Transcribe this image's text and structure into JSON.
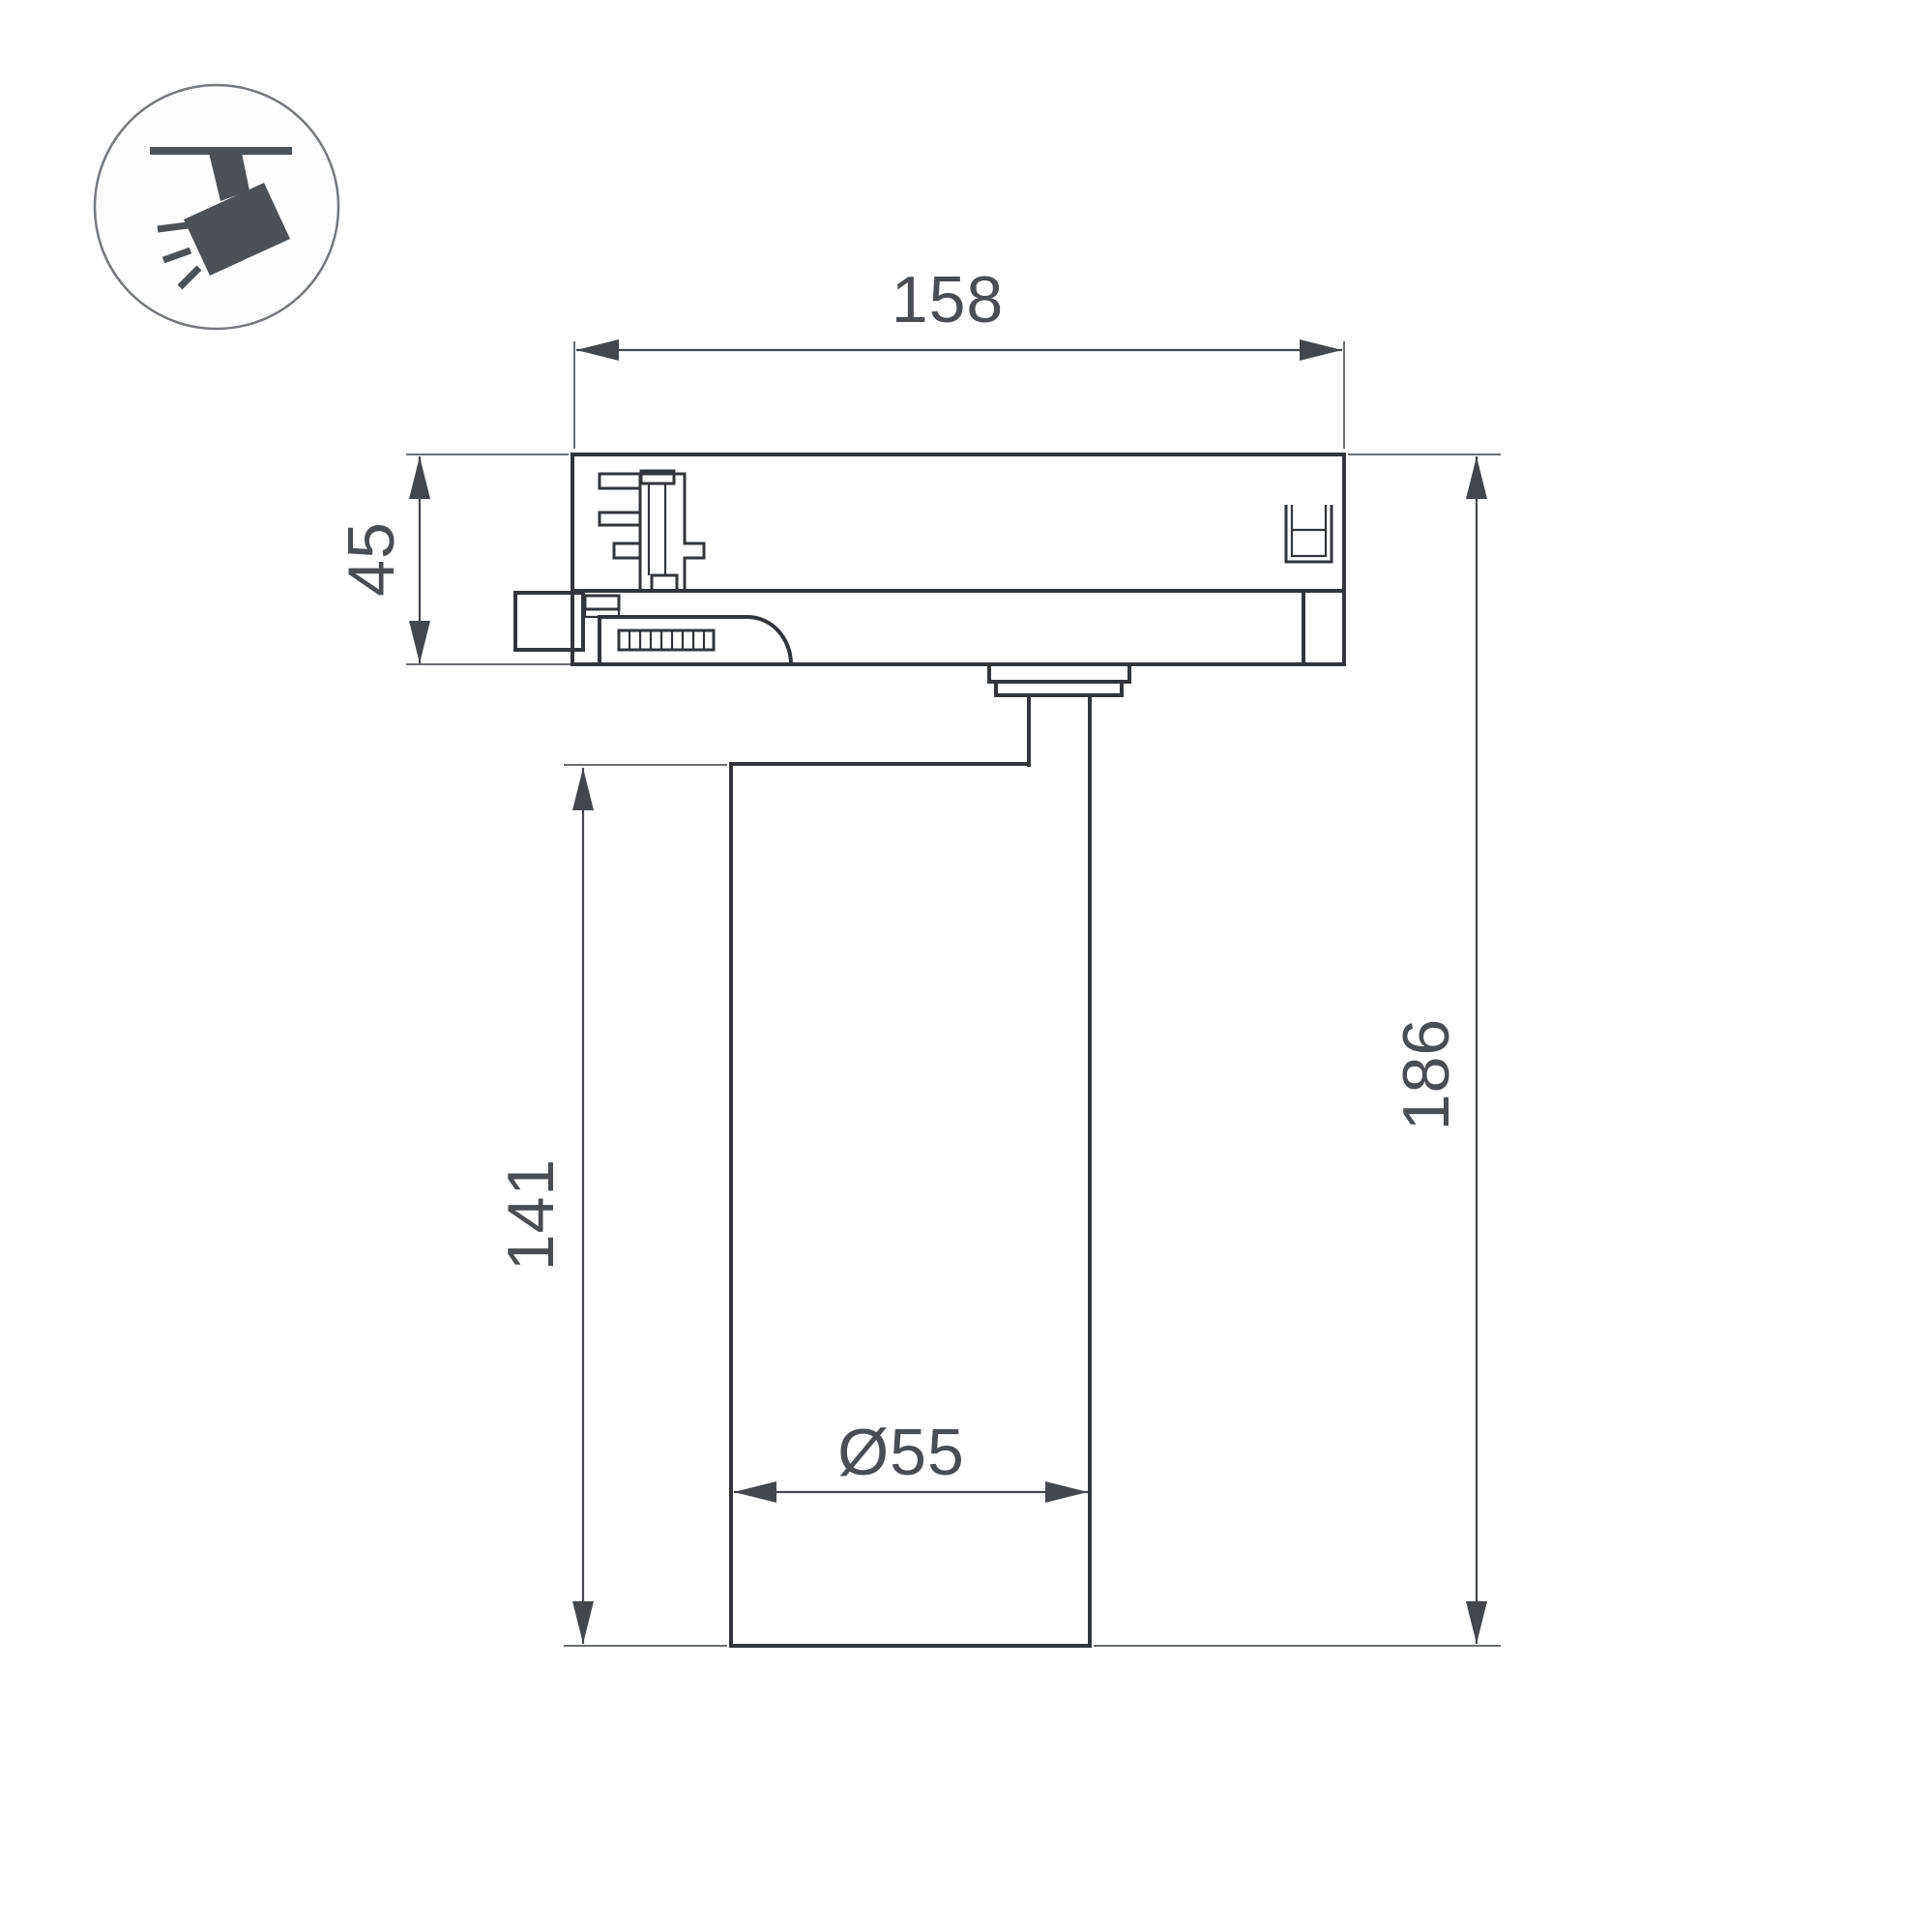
{
  "page": {
    "background": "#ffffff",
    "description": "Technical dimension drawing of a track-mounted spotlight luminaire, side view"
  },
  "icon": {
    "name": "track-spotlight",
    "fill": "#4b5155",
    "circle_stroke": "#75797d",
    "circle_fill": "#fdfdfe"
  },
  "diagram": {
    "labels": {
      "width": "158",
      "adapter_height": "45",
      "body_height": "141",
      "total_height": "186",
      "diameter": "Ø55"
    },
    "dimensions_mm": {
      "width": 158,
      "adapter_height": 45,
      "body_height": 141,
      "total_height": 186,
      "diameter": 55
    },
    "colors": {
      "outline": "#32363a",
      "dimension": "#43474b",
      "extension": "#6a6e72",
      "text": "#4a4e52"
    }
  }
}
